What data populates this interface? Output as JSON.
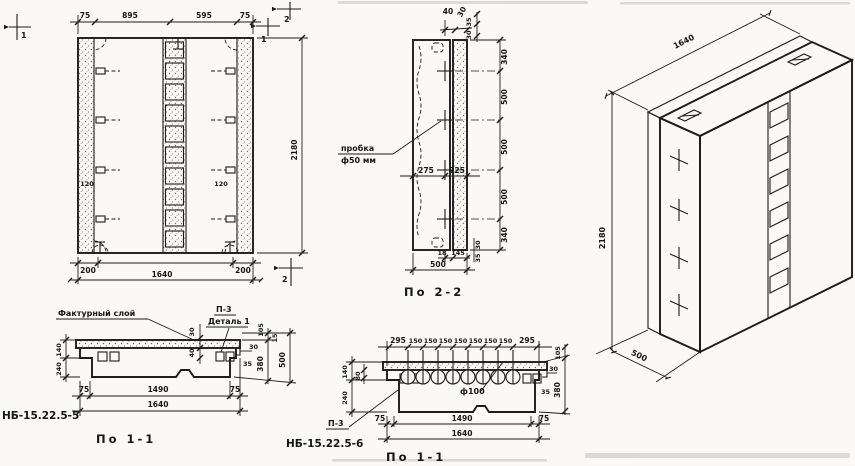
{
  "colors": {
    "ink": "#1c1c1c",
    "paper": "#faf9f5"
  },
  "elevation": {
    "sec1": "1",
    "sec2": "2",
    "top_dims": [
      "75",
      "895",
      "595",
      "75"
    ],
    "bottom_left": "200",
    "bottom_right": "200",
    "bottom_total": "1640",
    "height": "2180",
    "anchor_dim_left": "120",
    "anchor_dim_right": "120"
  },
  "section22": {
    "title": "По 2-2",
    "note_line1": "пробка",
    "note_line2": "ф50 мм",
    "top_dim1": "40",
    "top_dim2": "30",
    "top_dim3": "35",
    "top_dim4": "30",
    "mid_left": "275",
    "mid_right": "225",
    "right_dims": [
      "340",
      "500",
      "500",
      "500",
      "340"
    ],
    "bot_dim1": "18",
    "bot_dim2": "145",
    "bot_total": "500",
    "bot_rot1": "30",
    "bot_rot2": "35"
  },
  "section11a": {
    "title": "По 1-1",
    "mark": "НБ-15.22.5-5",
    "note_layer": "Фактурный слой",
    "note_p3": "П-3",
    "note_detail": "Деталь 1",
    "left_top": "140",
    "left_bottom": "240",
    "mid_rot1": "30",
    "mid_rot2": "40",
    "edge1": "30",
    "edge2": "35",
    "small1": "105",
    "small2": "15",
    "right_inner": "380",
    "right_outer": "500",
    "bottom": [
      "75",
      "1490",
      "75"
    ],
    "bottom_total": "1640"
  },
  "section11b": {
    "title": "По 1-1",
    "mark": "НБ-15.22.5-6",
    "note_p3": "П-3",
    "hole": "ф100",
    "top_dims": [
      "295",
      "150",
      "150",
      "150",
      "150",
      "150",
      "150",
      "150",
      "295"
    ],
    "left_top": "140",
    "left_bottom": "240",
    "left_small": "80",
    "edge1": "30",
    "edge2": "35",
    "small1": "105",
    "right": "380",
    "bottom": [
      "75",
      "1490",
      "75"
    ],
    "bottom_total": "1640"
  },
  "isometric": {
    "length": "1640",
    "height": "2180",
    "depth": "500"
  }
}
